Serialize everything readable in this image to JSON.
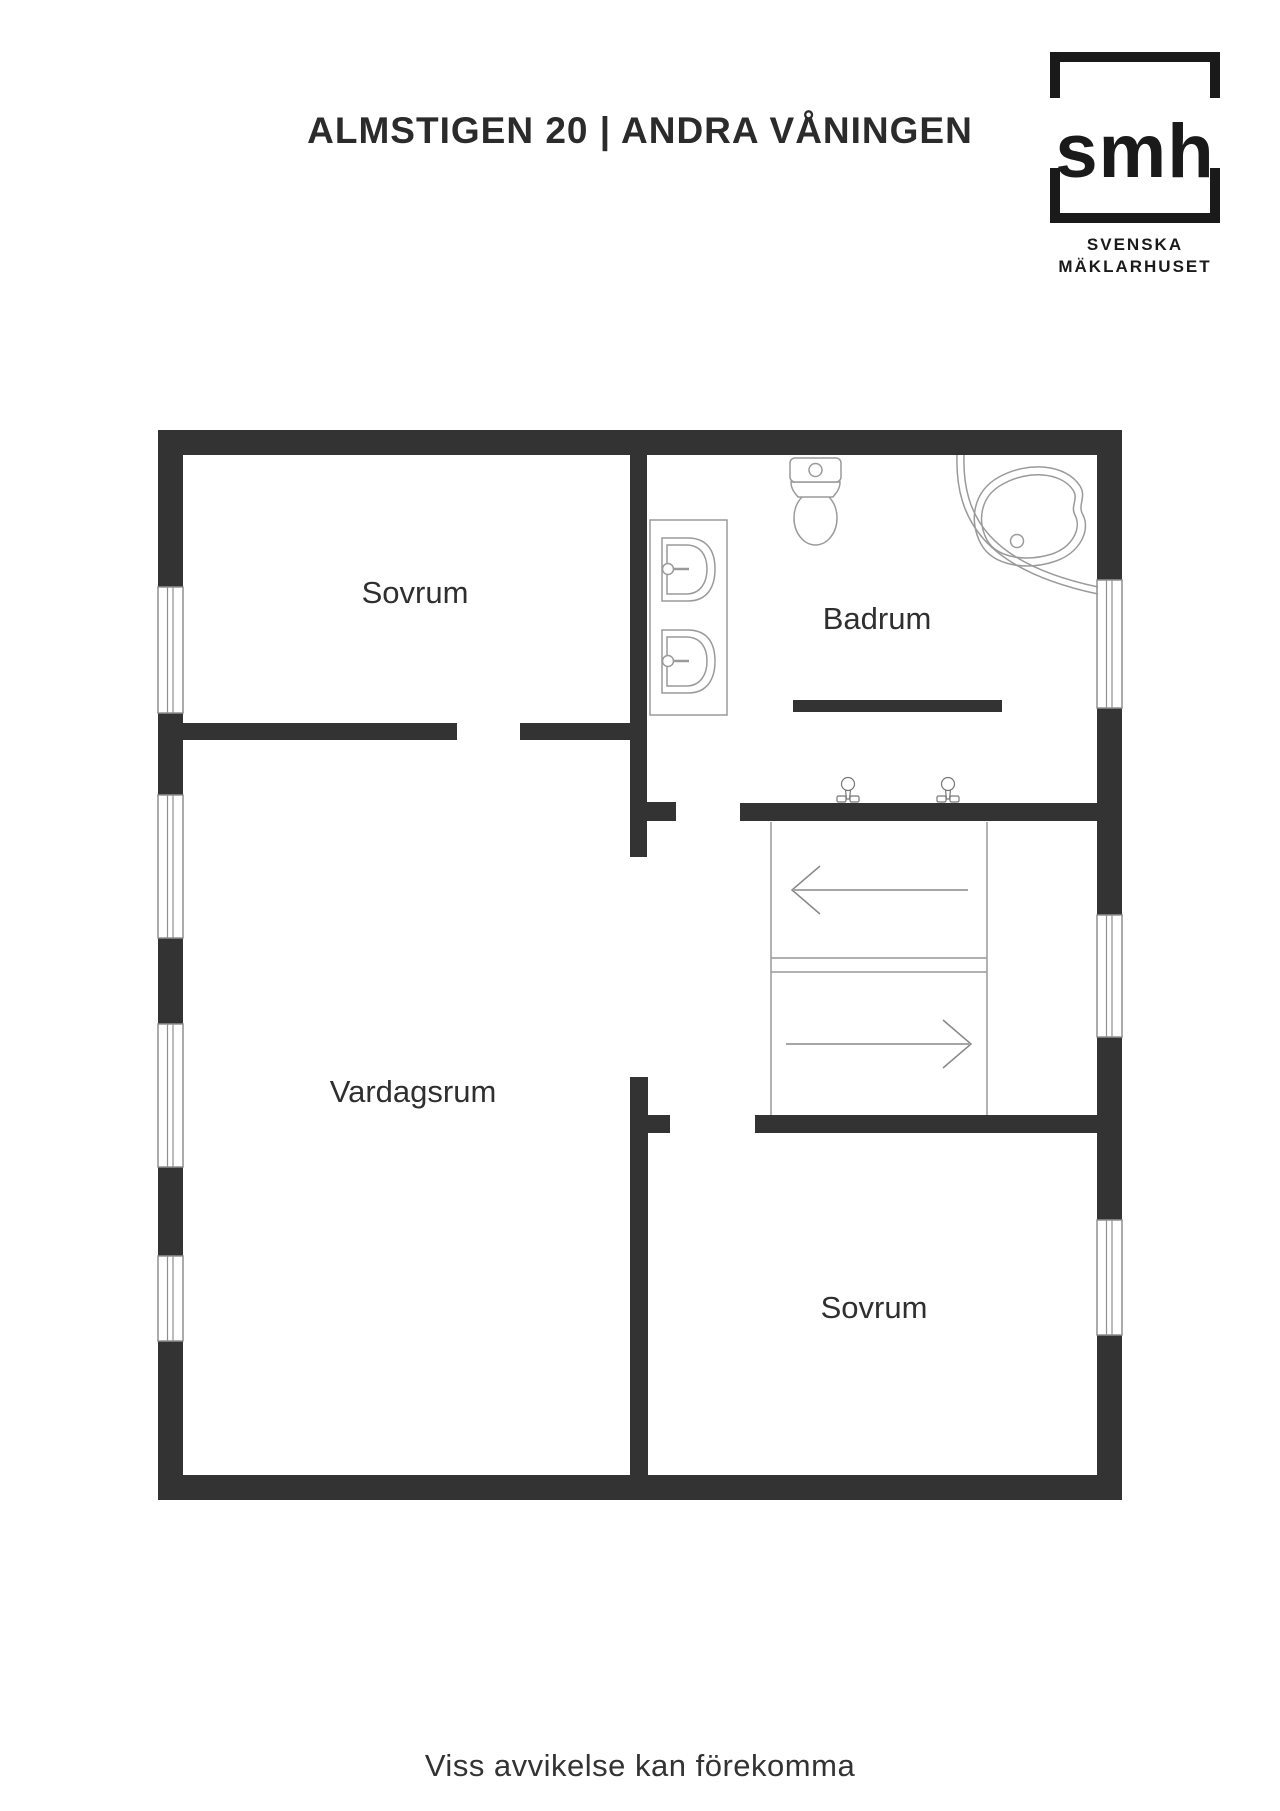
{
  "header": {
    "title": "ALMSTIGEN 20 | ANDRA VÅNINGEN"
  },
  "logo": {
    "monogram": "smh",
    "line1": "SVENSKA",
    "line2": "MÄKLARHUSET"
  },
  "plan": {
    "rooms": [
      {
        "label": "Sovrum"
      },
      {
        "label": "Badrum"
      },
      {
        "label": "Vardagsrum"
      },
      {
        "label": "Sovrum"
      }
    ],
    "fixtures": [
      "toilet",
      "corner-bathtub",
      "double-sink-counter",
      "two-taps",
      "staircase"
    ],
    "stairs_arrows": [
      "left",
      "right"
    ]
  },
  "footer": {
    "disclaimer": "Viss avvikelse kan förekomma"
  },
  "colors": {
    "wall": "#333333",
    "thin_line": "#999999",
    "text": "#2f2f2f",
    "logo": "#1a1a1a",
    "background": "#ffffff"
  }
}
